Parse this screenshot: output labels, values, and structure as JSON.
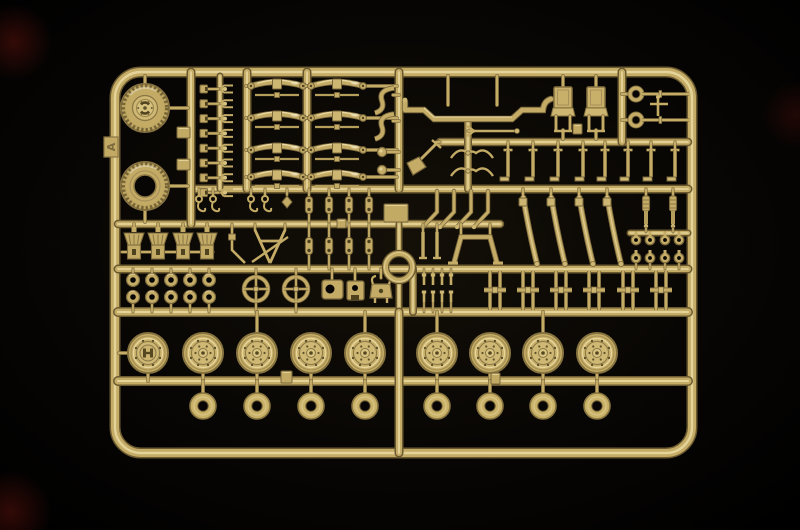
{
  "scene": {
    "subject": "tan plastic model-kit sprue photographed on black background",
    "tab_letter": "A"
  },
  "palette": {
    "background": "#030302",
    "vignette_center": "#14110c",
    "edge": "#6b5a30",
    "dark": "#4f421f",
    "shadow": "#7a683c",
    "base": "#c4ab66",
    "base2": "#cdb572",
    "light": "#d8c47f",
    "highlight": "#ead9a2",
    "specular": "#f6ecd0",
    "hole": "#070605",
    "tint_blob": "#5a120c"
  },
  "sprue": {
    "frame": {
      "x": 115,
      "y": 72,
      "width": 577,
      "height": 381,
      "corner_radius": 26
    },
    "rails_h": [
      {
        "x1": 191,
        "y": 189,
        "x2": 688,
        "w": 6
      },
      {
        "x1": 440,
        "y": 142,
        "x2": 688,
        "w": 5.5
      },
      {
        "x1": 118,
        "y": 224,
        "x2": 500,
        "w": 5.5
      },
      {
        "x1": 630,
        "y": 233,
        "x2": 688,
        "w": 4
      },
      {
        "x1": 118,
        "y": 269,
        "x2": 688,
        "w": 6
      },
      {
        "x1": 118,
        "y": 312,
        "x2": 688,
        "w": 7
      },
      {
        "x1": 118,
        "y": 381,
        "x2": 688,
        "w": 7
      }
    ],
    "rails_v": [
      {
        "x": 191,
        "y1": 72,
        "y2": 224,
        "w": 6
      },
      {
        "x": 220,
        "y1": 76,
        "y2": 189,
        "w": 4
      },
      {
        "x": 247,
        "y1": 72,
        "y2": 189,
        "w": 6
      },
      {
        "x": 307,
        "y1": 72,
        "y2": 189,
        "w": 6
      },
      {
        "x": 399,
        "y1": 72,
        "y2": 189,
        "w": 6
      },
      {
        "x": 399,
        "y1": 224,
        "y2": 253,
        "w": 4
      },
      {
        "x": 399,
        "y1": 280,
        "y2": 312,
        "w": 4
      },
      {
        "x": 399,
        "y1": 312,
        "y2": 453,
        "w": 6
      },
      {
        "x": 413,
        "y1": 269,
        "y2": 312,
        "w": 5
      },
      {
        "x": 468,
        "y1": 122,
        "y2": 189,
        "w": 5
      },
      {
        "x": 622,
        "y1": 72,
        "y2": 142,
        "w": 6
      }
    ],
    "tire_wheel": {
      "cx": 145,
      "cy": 108,
      "radius": 24
    },
    "tire_only": {
      "cx": 145,
      "cy": 186,
      "radius": 24,
      "hole_radius": 11
    },
    "road_wheels": {
      "cy": 353,
      "radius": 20,
      "cx": [
        148,
        203,
        257,
        311,
        365,
        437,
        490,
        543,
        597
      ],
      "stem_up_cx": [
        257,
        365,
        437,
        543
      ]
    },
    "washers": {
      "cy": 406,
      "outer_radius": 13,
      "hole_radius": 5.2,
      "cx": [
        203,
        257,
        311,
        365,
        437,
        490,
        543,
        597
      ]
    },
    "small_rings": {
      "rows": [
        280,
        297
      ],
      "radius": 6.5,
      "hole_radius": 2.8,
      "cx": [
        133,
        152,
        171,
        190,
        209
      ]
    },
    "steering_wheels": {
      "cy": 289,
      "radius": 12,
      "cx": [
        256,
        296
      ]
    },
    "axle_crosses": {
      "cy": 290,
      "cx": [
        495,
        528,
        561,
        594,
        628,
        661
      ]
    },
    "lever_rods": {
      "rail_y": 142,
      "cx": [
        508,
        533,
        558,
        583,
        605,
        628,
        651,
        675
      ]
    },
    "leaf_springs": {
      "rows_cy": [
        86,
        118,
        150,
        177
      ],
      "col_x": [
        251,
        311
      ],
      "length": 52
    },
    "slanted_springs": {
      "top_y": 196,
      "bottom_y": 264,
      "top_cx": [
        523,
        551,
        579,
        607
      ],
      "slant": 14
    },
    "d_bits": {
      "x": 204,
      "start_y": 89,
      "step": 14.8,
      "count": 8
    },
    "fork_bits": {
      "x": 224,
      "start_y": 89,
      "step": 14.8,
      "count": 8
    },
    "funnels": {
      "top_y": 233,
      "cx": [
        134,
        158,
        183,
        207
      ]
    },
    "links": {
      "rows_cy": [
        205,
        246
      ],
      "cx": [
        309,
        329,
        349,
        369
      ]
    },
    "pins": {
      "rows_cy": [
        280,
        297
      ],
      "cx": [
        424,
        433,
        442,
        451
      ]
    },
    "hooks": {
      "cy": 203,
      "cx": [
        199,
        213,
        251,
        265,
        287
      ]
    },
    "eyelets": {
      "rows_cy": [
        240,
        258
      ],
      "cx": [
        636,
        650,
        665,
        679
      ]
    },
    "shock_absorbers": {
      "cx": [
        646,
        673
      ],
      "top_y": 196
    },
    "seats": {
      "cx": [
        563,
        596
      ]
    },
    "tow_shackles": {
      "cy": [
        94,
        120
      ],
      "ring_x": 636,
      "rod_end": 689
    },
    "ring_boss": {
      "cx": 399,
      "cy": 267,
      "outer_radius": 13.5,
      "ring_width": 5
    },
    "gate_tabs": [
      {
        "x": 177,
        "y": 127,
        "w": 13,
        "h": 11
      },
      {
        "x": 177,
        "y": 159,
        "w": 13,
        "h": 11
      },
      {
        "x": 384,
        "y": 204,
        "w": 24,
        "h": 18
      },
      {
        "x": 281,
        "y": 371,
        "w": 11,
        "h": 12
      },
      {
        "x": 491,
        "y": 373,
        "w": 9,
        "h": 11
      },
      {
        "x": 573,
        "y": 124,
        "w": 9,
        "h": 10
      },
      {
        "x": 337,
        "y": 219,
        "w": 9,
        "h": 9
      }
    ],
    "tab": {
      "x": 104,
      "y": 137,
      "w": 14,
      "h": 20
    }
  }
}
